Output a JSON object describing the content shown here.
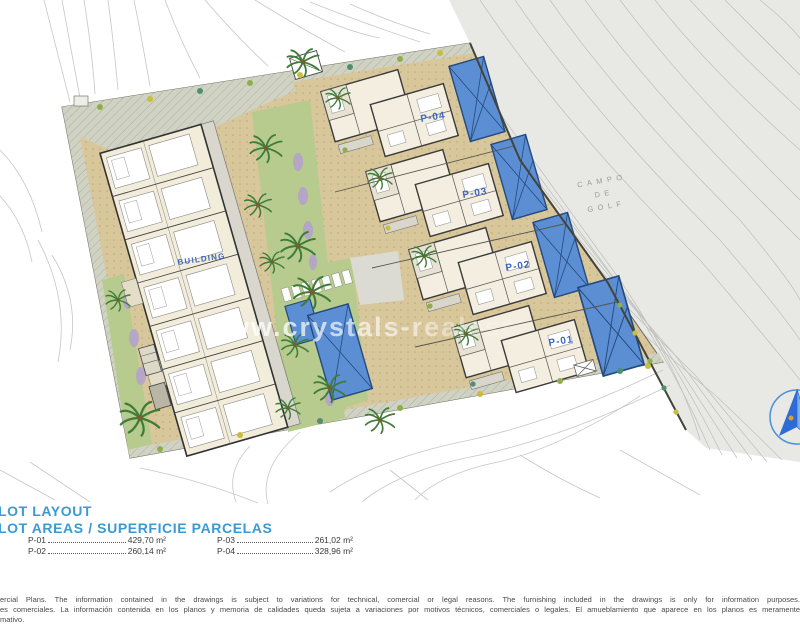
{
  "plan": {
    "watermark": "www.crystals-realest",
    "building_label": "BUILDING",
    "plot_labels": [
      "P-04",
      "P-03",
      "P-02",
      "P-01"
    ],
    "golf": [
      "CAMPO",
      "DE",
      "GOLF"
    ]
  },
  "legend": {
    "title": "PLOT LAYOUT",
    "subtitle": "PLOT AREAS / SUPERFICIE PARCELAS",
    "plots": [
      {
        "label": "P-01",
        "area": "429,70 m²"
      },
      {
        "label": "P-02",
        "area": "260,14 m²"
      },
      {
        "label": "P-03",
        "area": "261,02 m²"
      },
      {
        "label": "P-04",
        "area": "328,96 m²"
      }
    ]
  },
  "disclaimer": {
    "line1": "ercial Plans. The information contained in the drawings is subject to variations for technical, comercial or legal reasons. The furnishing included in the drawings is only for information purposes.",
    "line2": "es comerciales. La información contenida en los planos y memoria de calidades queda sujeta a variaciones por motivos técnicos, comerciales o legales. El amueblamiento que aparece en los planos es meramente",
    "line3": "mativo."
  },
  "colors": {
    "legend_blue": "#3a9ad2",
    "plot_label_blue": "#3c67bf",
    "pool_blue": "#5b8ed3",
    "pool_border": "#24497e",
    "paving_tan": "#d9c79c",
    "lawn_green": "#b6cb8d",
    "road_grey": "#d0d3c4",
    "terrain_grey": "#e8e8e5",
    "golf_text_grey": "#9b9b9b"
  }
}
